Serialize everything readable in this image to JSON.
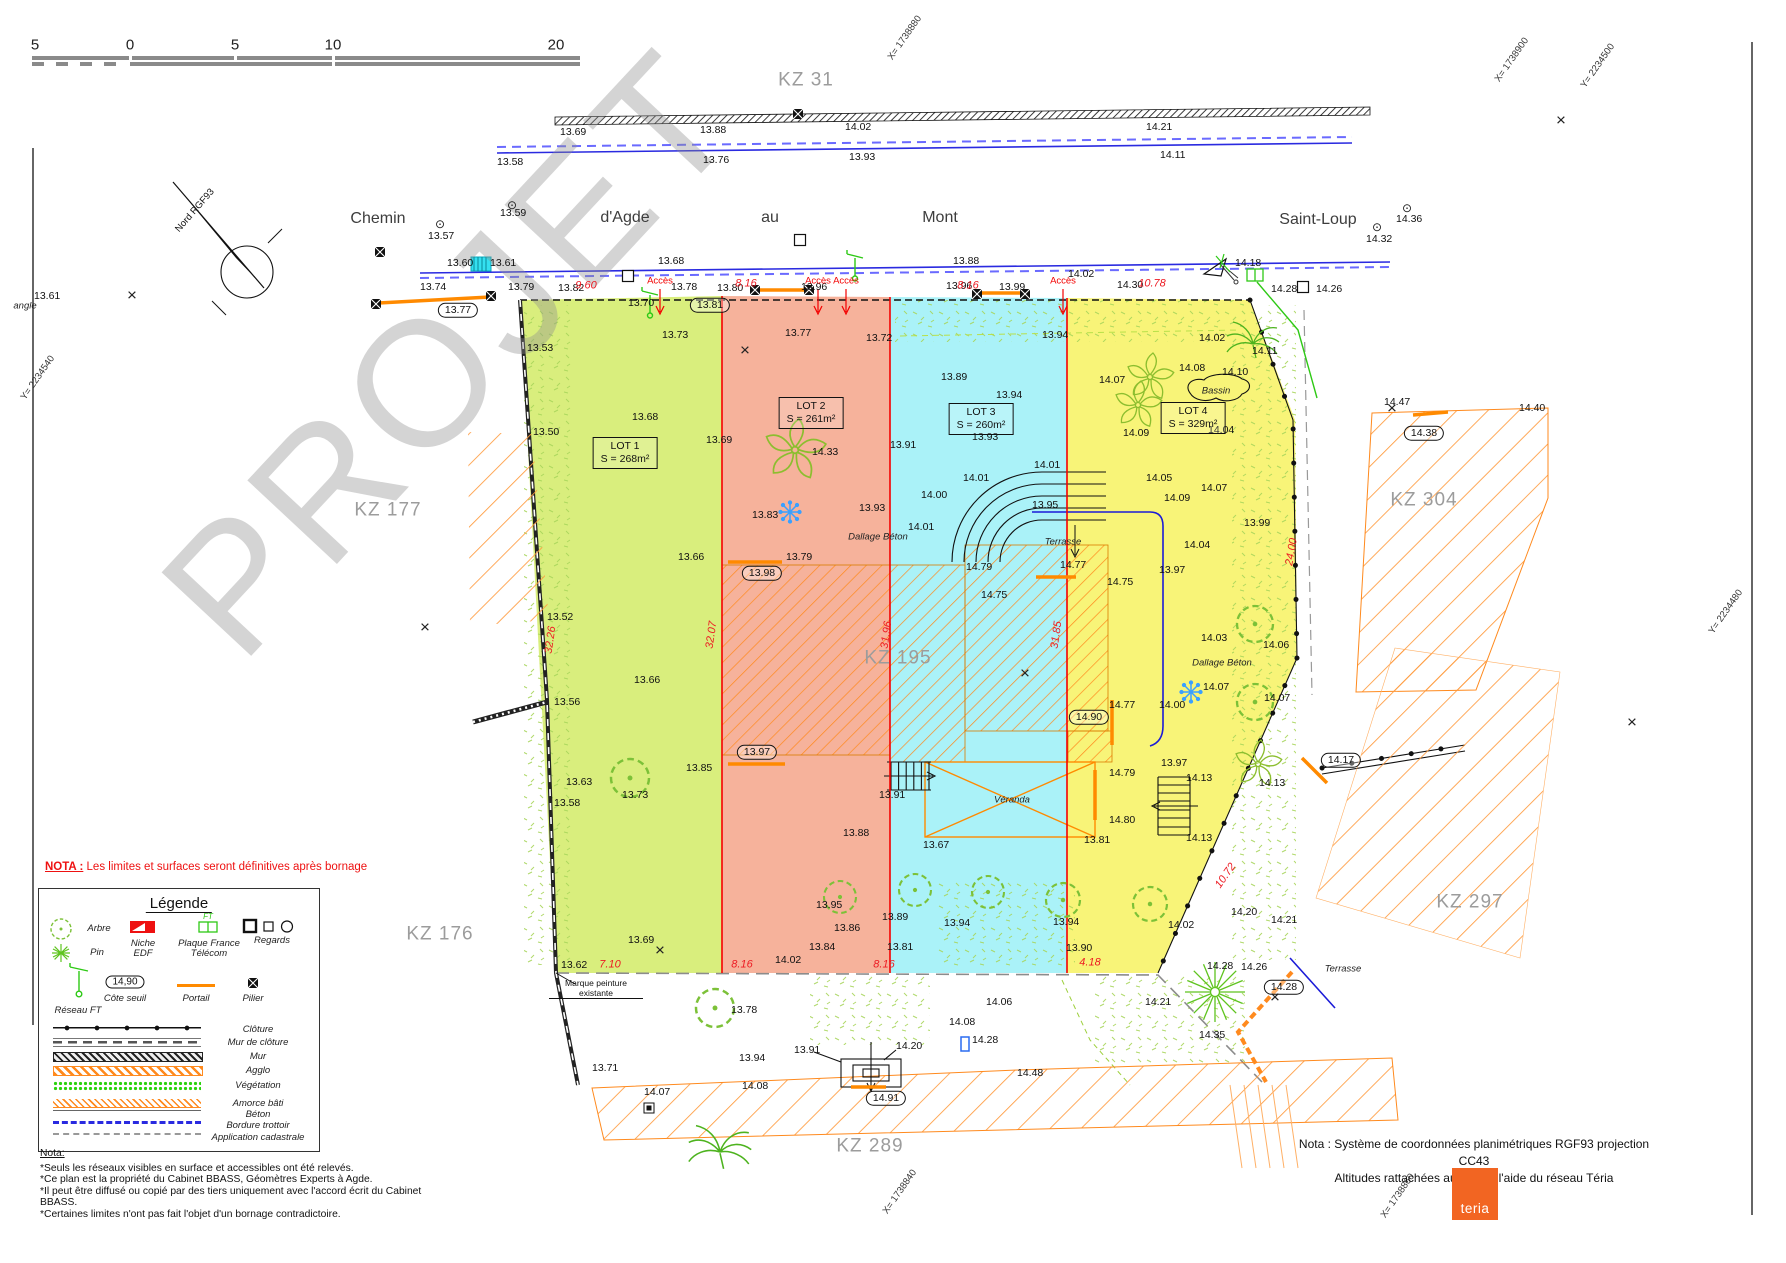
{
  "watermark": "PROJET",
  "north_label": "Nord RGF93",
  "scale_ticks": [
    [
      35,
      45,
      "5"
    ],
    [
      130,
      45,
      "0"
    ],
    [
      235,
      45,
      "5"
    ],
    [
      333,
      45,
      "10"
    ],
    [
      556,
      45,
      "20"
    ]
  ],
  "streets": [
    [
      378,
      219,
      "Chemin"
    ],
    [
      625,
      218,
      "d'Agde"
    ],
    [
      770,
      218,
      "au"
    ],
    [
      940,
      218,
      "Mont"
    ],
    [
      1318,
      220,
      "Saint-Loup"
    ]
  ],
  "parcels": [
    [
      806,
      80,
      "KZ 31"
    ],
    [
      388,
      510,
      "KZ 177"
    ],
    [
      440,
      934,
      "KZ 176"
    ],
    [
      898,
      658,
      "KZ 195"
    ],
    [
      1424,
      500,
      "KZ 304"
    ],
    [
      1470,
      902,
      "KZ 297"
    ],
    [
      870,
      1146,
      "KZ 289"
    ]
  ],
  "lots": [
    {
      "name": "LOT 1",
      "area": "S = 268m²",
      "x": 625,
      "y": 453
    },
    {
      "name": "LOT 2",
      "area": "S = 261m²",
      "x": 811,
      "y": 413
    },
    {
      "name": "LOT 3",
      "area": "S = 260m²",
      "x": 981,
      "y": 419
    },
    {
      "name": "LOT 4",
      "area": "S = 329m²",
      "x": 1193,
      "y": 418
    }
  ],
  "geo_coords": [
    [
      905,
      38,
      "X= 1738880"
    ],
    [
      1512,
      60,
      "X= 1738900"
    ],
    [
      1598,
      66,
      "Y= 2234500"
    ],
    [
      38,
      378,
      "Y= 2234540"
    ],
    [
      1726,
      612,
      "Y= 2234480"
    ],
    [
      900,
      1192,
      "X= 1738840"
    ],
    [
      1398,
      1196,
      "X= 1738860"
    ]
  ],
  "acces_label": "Accès",
  "acces_points": [
    [
      660,
      281
    ],
    [
      818,
      281
    ],
    [
      846,
      281
    ],
    [
      1063,
      281
    ]
  ],
  "dims": [
    {
      "t": "9.60",
      "x": 586,
      "y": 286
    },
    {
      "t": "8.16",
      "x": 746,
      "y": 284
    },
    {
      "t": "8.16",
      "x": 968,
      "y": 286
    },
    {
      "t": "10.78",
      "x": 1152,
      "y": 284
    },
    {
      "t": "7.10",
      "x": 610,
      "y": 965
    },
    {
      "t": "8.16",
      "x": 742,
      "y": 965
    },
    {
      "t": "8.16",
      "x": 884,
      "y": 965
    },
    {
      "t": "4.18",
      "x": 1090,
      "y": 963
    },
    {
      "t": "32.26",
      "x": 551,
      "y": 640,
      "r": -82
    },
    {
      "t": "32.07",
      "x": 712,
      "y": 635,
      "r": -82
    },
    {
      "t": "31.96",
      "x": 887,
      "y": 635,
      "r": -82
    },
    {
      "t": "31.85",
      "x": 1057,
      "y": 635,
      "r": -82
    },
    {
      "t": "24.00",
      "x": 1292,
      "y": 552,
      "r": -80
    },
    {
      "t": "10.72",
      "x": 1226,
      "y": 876,
      "r": -55
    }
  ],
  "ovals": [
    [
      458,
      310,
      "13.77"
    ],
    [
      710,
      305,
      "13.81"
    ],
    [
      762,
      573,
      "13.98"
    ],
    [
      757,
      752,
      "13.97"
    ],
    [
      1089,
      717,
      "14.90"
    ],
    [
      886,
      1098,
      "14.91"
    ],
    [
      1341,
      760,
      "14.17"
    ],
    [
      1284,
      987,
      "14.28"
    ],
    [
      1424,
      433,
      "14.38"
    ]
  ],
  "notes_italic": [
    [
      1063,
      542,
      "Terrasse"
    ],
    [
      1343,
      969,
      "Terrasse"
    ],
    [
      1012,
      800,
      "Véranda"
    ],
    [
      1216,
      391,
      "Bassin"
    ],
    [
      878,
      537,
      "Dallage Béton"
    ],
    [
      1222,
      663,
      "Dallage Béton"
    ],
    [
      25,
      306,
      "angle"
    ]
  ],
  "marque_label": "Marque peinture existante",
  "crosses": [
    [
      132,
      295
    ],
    [
      745,
      350
    ],
    [
      425,
      627
    ],
    [
      1025,
      673
    ],
    [
      660,
      950
    ],
    [
      1561,
      120
    ],
    [
      1632,
      722
    ],
    [
      1275,
      997
    ],
    [
      1392,
      408
    ]
  ],
  "circle_points": [
    [
      440,
      224
    ],
    [
      512,
      205
    ],
    [
      1377,
      227
    ],
    [
      1407,
      208
    ]
  ],
  "spots": [
    [
      560,
      132,
      "13.69"
    ],
    [
      700,
      130,
      "13.88"
    ],
    [
      845,
      127,
      "14.02"
    ],
    [
      1146,
      127,
      "14.21"
    ],
    [
      497,
      162,
      "13.58"
    ],
    [
      703,
      160,
      "13.76"
    ],
    [
      849,
      157,
      "13.93"
    ],
    [
      1160,
      155,
      "14.11"
    ],
    [
      428,
      236,
      "13.57"
    ],
    [
      500,
      213,
      "13.59"
    ],
    [
      1366,
      239,
      "14.32"
    ],
    [
      1396,
      219,
      "14.36"
    ],
    [
      34,
      296,
      "13.61"
    ],
    [
      447,
      263,
      "13.60"
    ],
    [
      490,
      263,
      "13.61"
    ],
    [
      658,
      261,
      "13.68"
    ],
    [
      953,
      261,
      "13.88"
    ],
    [
      1068,
      274,
      "14.02"
    ],
    [
      1235,
      263,
      "14.18"
    ],
    [
      420,
      287,
      "13.74"
    ],
    [
      508,
      287,
      "13.79"
    ],
    [
      558,
      288,
      "13.82"
    ],
    [
      628,
      303,
      "13.70"
    ],
    [
      671,
      287,
      "13.78"
    ],
    [
      717,
      288,
      "13.80"
    ],
    [
      801,
      287,
      "13.96"
    ],
    [
      946,
      286,
      "13.96"
    ],
    [
      999,
      287,
      "13.99"
    ],
    [
      1117,
      285,
      "14.30"
    ],
    [
      1271,
      289,
      "14.28"
    ],
    [
      1316,
      289,
      "14.26"
    ],
    [
      527,
      348,
      "13.53"
    ],
    [
      662,
      335,
      "13.73"
    ],
    [
      533,
      432,
      "13.50"
    ],
    [
      632,
      417,
      "13.68"
    ],
    [
      706,
      440,
      "13.69"
    ],
    [
      547,
      617,
      "13.52"
    ],
    [
      554,
      702,
      "13.56"
    ],
    [
      678,
      557,
      "13.66"
    ],
    [
      634,
      680,
      "13.66"
    ],
    [
      566,
      782,
      "13.63"
    ],
    [
      554,
      803,
      "13.58"
    ],
    [
      622,
      795,
      "13.73"
    ],
    [
      686,
      768,
      "13.85"
    ],
    [
      628,
      940,
      "13.69"
    ],
    [
      561,
      965,
      "13.62"
    ],
    [
      785,
      333,
      "13.77"
    ],
    [
      866,
      338,
      "13.72"
    ],
    [
      812,
      452,
      "14.33"
    ],
    [
      752,
      515,
      "13.83"
    ],
    [
      859,
      508,
      "13.93"
    ],
    [
      890,
      445,
      "13.91"
    ],
    [
      786,
      557,
      "13.79"
    ],
    [
      843,
      833,
      "13.88"
    ],
    [
      775,
      960,
      "14.02"
    ],
    [
      941,
      377,
      "13.89"
    ],
    [
      1042,
      335,
      "13.94"
    ],
    [
      996,
      395,
      "13.94"
    ],
    [
      972,
      437,
      "13.93"
    ],
    [
      1034,
      465,
      "14.01"
    ],
    [
      963,
      478,
      "14.01"
    ],
    [
      908,
      527,
      "14.01"
    ],
    [
      921,
      495,
      "14.00"
    ],
    [
      1032,
      505,
      "13.95"
    ],
    [
      966,
      567,
      "14.79"
    ],
    [
      1060,
      565,
      "14.77"
    ],
    [
      981,
      595,
      "14.75"
    ],
    [
      879,
      795,
      "13.91"
    ],
    [
      923,
      845,
      "13.67"
    ],
    [
      816,
      905,
      "13.95"
    ],
    [
      882,
      917,
      "13.89"
    ],
    [
      944,
      923,
      "13.94"
    ],
    [
      834,
      928,
      "13.86"
    ],
    [
      809,
      947,
      "13.84"
    ],
    [
      887,
      947,
      "13.81"
    ],
    [
      1199,
      338,
      "14.02"
    ],
    [
      1252,
      351,
      "14.11"
    ],
    [
      1179,
      368,
      "14.08"
    ],
    [
      1222,
      372,
      "14.10"
    ],
    [
      1099,
      380,
      "14.07"
    ],
    [
      1123,
      433,
      "14.09"
    ],
    [
      1208,
      430,
      "14.04"
    ],
    [
      1146,
      478,
      "14.05"
    ],
    [
      1201,
      488,
      "14.07"
    ],
    [
      1164,
      498,
      "14.09"
    ],
    [
      1244,
      523,
      "13.99"
    ],
    [
      1184,
      545,
      "14.04"
    ],
    [
      1159,
      570,
      "13.97"
    ],
    [
      1107,
      582,
      "14.75"
    ],
    [
      1201,
      638,
      "14.03"
    ],
    [
      1263,
      645,
      "14.06"
    ],
    [
      1203,
      687,
      "14.07"
    ],
    [
      1264,
      698,
      "14.07"
    ],
    [
      1159,
      705,
      "14.00"
    ],
    [
      1109,
      705,
      "14.77"
    ],
    [
      1109,
      773,
      "14.79"
    ],
    [
      1109,
      820,
      "14.80"
    ],
    [
      1084,
      840,
      "13.81"
    ],
    [
      1161,
      763,
      "13.97"
    ],
    [
      1186,
      778,
      "14.13"
    ],
    [
      1186,
      838,
      "14.13"
    ],
    [
      1259,
      783,
      "14.13"
    ],
    [
      1053,
      922,
      "13.94"
    ],
    [
      1231,
      912,
      "14.20"
    ],
    [
      1271,
      920,
      "14.21"
    ],
    [
      1168,
      925,
      "14.02"
    ],
    [
      1066,
      948,
      "13.90"
    ],
    [
      1384,
      402,
      "14.47"
    ],
    [
      1519,
      408,
      "14.40"
    ],
    [
      1207,
      966,
      "14.28"
    ],
    [
      1241,
      967,
      "14.26"
    ],
    [
      1199,
      1035,
      "14.35"
    ],
    [
      1017,
      1073,
      "14.48"
    ],
    [
      592,
      1068,
      "13.71"
    ],
    [
      731,
      1010,
      "13.78"
    ],
    [
      739,
      1058,
      "13.94"
    ],
    [
      644,
      1092,
      "14.07"
    ],
    [
      742,
      1086,
      "14.08"
    ],
    [
      986,
      1002,
      "14.06"
    ],
    [
      949,
      1022,
      "14.08"
    ],
    [
      972,
      1040,
      "14.28"
    ],
    [
      1145,
      1002,
      "14.21"
    ],
    [
      794,
      1050,
      "13.91"
    ],
    [
      896,
      1046,
      "14.20"
    ]
  ],
  "symbols": [
    {
      "k": "tree",
      "x": 630,
      "y": 778,
      "s": 1.9
    },
    {
      "k": "tree",
      "x": 840,
      "y": 897,
      "s": 1.6
    },
    {
      "k": "tree",
      "x": 915,
      "y": 890,
      "s": 1.6
    },
    {
      "k": "tree",
      "x": 988,
      "y": 892,
      "s": 1.6
    },
    {
      "k": "tree",
      "x": 1063,
      "y": 900,
      "s": 1.7
    },
    {
      "k": "tree",
      "x": 1150,
      "y": 904,
      "s": 1.7
    },
    {
      "k": "tree",
      "x": 1255,
      "y": 624,
      "s": 1.8
    },
    {
      "k": "tree",
      "x": 1255,
      "y": 702,
      "s": 1.8
    },
    {
      "k": "tree",
      "x": 715,
      "y": 1008,
      "s": 1.9
    },
    {
      "k": "pinwheel",
      "x": 795,
      "y": 450,
      "s": 1.3
    },
    {
      "k": "pinwheel",
      "x": 1150,
      "y": 377
    },
    {
      "k": "pinwheel",
      "x": 1138,
      "y": 405
    },
    {
      "k": "pinwheel",
      "x": 1258,
      "y": 764
    },
    {
      "k": "palm",
      "x": 1253,
      "y": 344
    },
    {
      "k": "palm",
      "x": 720,
      "y": 1152,
      "s": 1.2
    },
    {
      "k": "star",
      "x": 1215,
      "y": 992
    },
    {
      "k": "flake",
      "x": 790,
      "y": 512
    },
    {
      "k": "flake",
      "x": 1191,
      "y": 692
    },
    {
      "k": "reseau",
      "x": 650,
      "y": 297
    },
    {
      "k": "reseau",
      "x": 855,
      "y": 260
    },
    {
      "k": "ftsq",
      "x": 1255,
      "y": 275
    },
    {
      "k": "culvert",
      "x": 481,
      "y": 264
    },
    {
      "k": "regard",
      "x": 800,
      "y": 240
    },
    {
      "k": "regard",
      "x": 628,
      "y": 276
    },
    {
      "k": "regard",
      "x": 1303,
      "y": 287
    },
    {
      "k": "pilier",
      "x": 798,
      "y": 114
    },
    {
      "k": "pilier",
      "x": 380,
      "y": 252
    },
    {
      "k": "pilier",
      "x": 376,
      "y": 304
    },
    {
      "k": "pilier",
      "x": 491,
      "y": 296
    },
    {
      "k": "pilier",
      "x": 755,
      "y": 290
    },
    {
      "k": "pilier",
      "x": 809,
      "y": 290
    },
    {
      "k": "pilier",
      "x": 977,
      "y": 294
    },
    {
      "k": "pilier",
      "x": 1025,
      "y": 294
    },
    {
      "k": "bluerect",
      "x": 965,
      "y": 1044
    },
    {
      "k": "blacksq",
      "x": 649,
      "y": 1108
    },
    {
      "k": "tri",
      "x": 1216,
      "y": 266
    }
  ],
  "nota_banner_label": "NOTA :",
  "nota_banner_text": "Les limites et surfaces seront définitives après bornage",
  "legend": {
    "title": "Légende",
    "symbols": [
      {
        "label": "Arbre"
      },
      {
        "label": "Pin"
      },
      {
        "label": "Niche EDF"
      },
      {
        "label": "Plaque France Télécom"
      },
      {
        "label": "Regards"
      },
      {
        "label": "Réseau FT"
      },
      {
        "label": "Côte seuil",
        "value": "14,90"
      },
      {
        "label": "Portail"
      },
      {
        "label": "Pilier"
      }
    ],
    "ft_tag": "FT",
    "lines": [
      {
        "k": "cloture",
        "label": "Clôture"
      },
      {
        "k": "murcloture",
        "label": "Mur de clôture"
      },
      {
        "k": "mur",
        "label": "Mur"
      },
      {
        "k": "agglo",
        "label": "Agglo"
      },
      {
        "k": "vegetation",
        "label": "Végétation"
      },
      {
        "k": "amorce",
        "label": "Amorce bâti"
      },
      {
        "k": "beton",
        "label": "Béton"
      },
      {
        "k": "bordure",
        "label": "Bordure trottoir"
      },
      {
        "k": "cadastrale",
        "label": "Application cadastrale"
      }
    ]
  },
  "nota_left": {
    "title": "Nota:",
    "lines": [
      "*Seuls les réseaux visibles en surface et accessibles ont été relevés.",
      "*Ce plan est la propriété du Cabinet BBASS, Géomètres Experts à Agde.",
      "*Il peut être diffusé ou copié par des tiers uniquement avec l'accord écrit du Cabinet BBASS.",
      "*Certaines limites n'ont pas fait l'objet d'un bornage contradictoire."
    ]
  },
  "nota_right": {
    "lines": [
      "Nota : Système de coordonnées planimétriques RGF93 projection CC43",
      "Altitudes rattachées au NGF à l'aide du réseau Téria"
    ]
  },
  "brand": {
    "logo_text": "teria"
  }
}
